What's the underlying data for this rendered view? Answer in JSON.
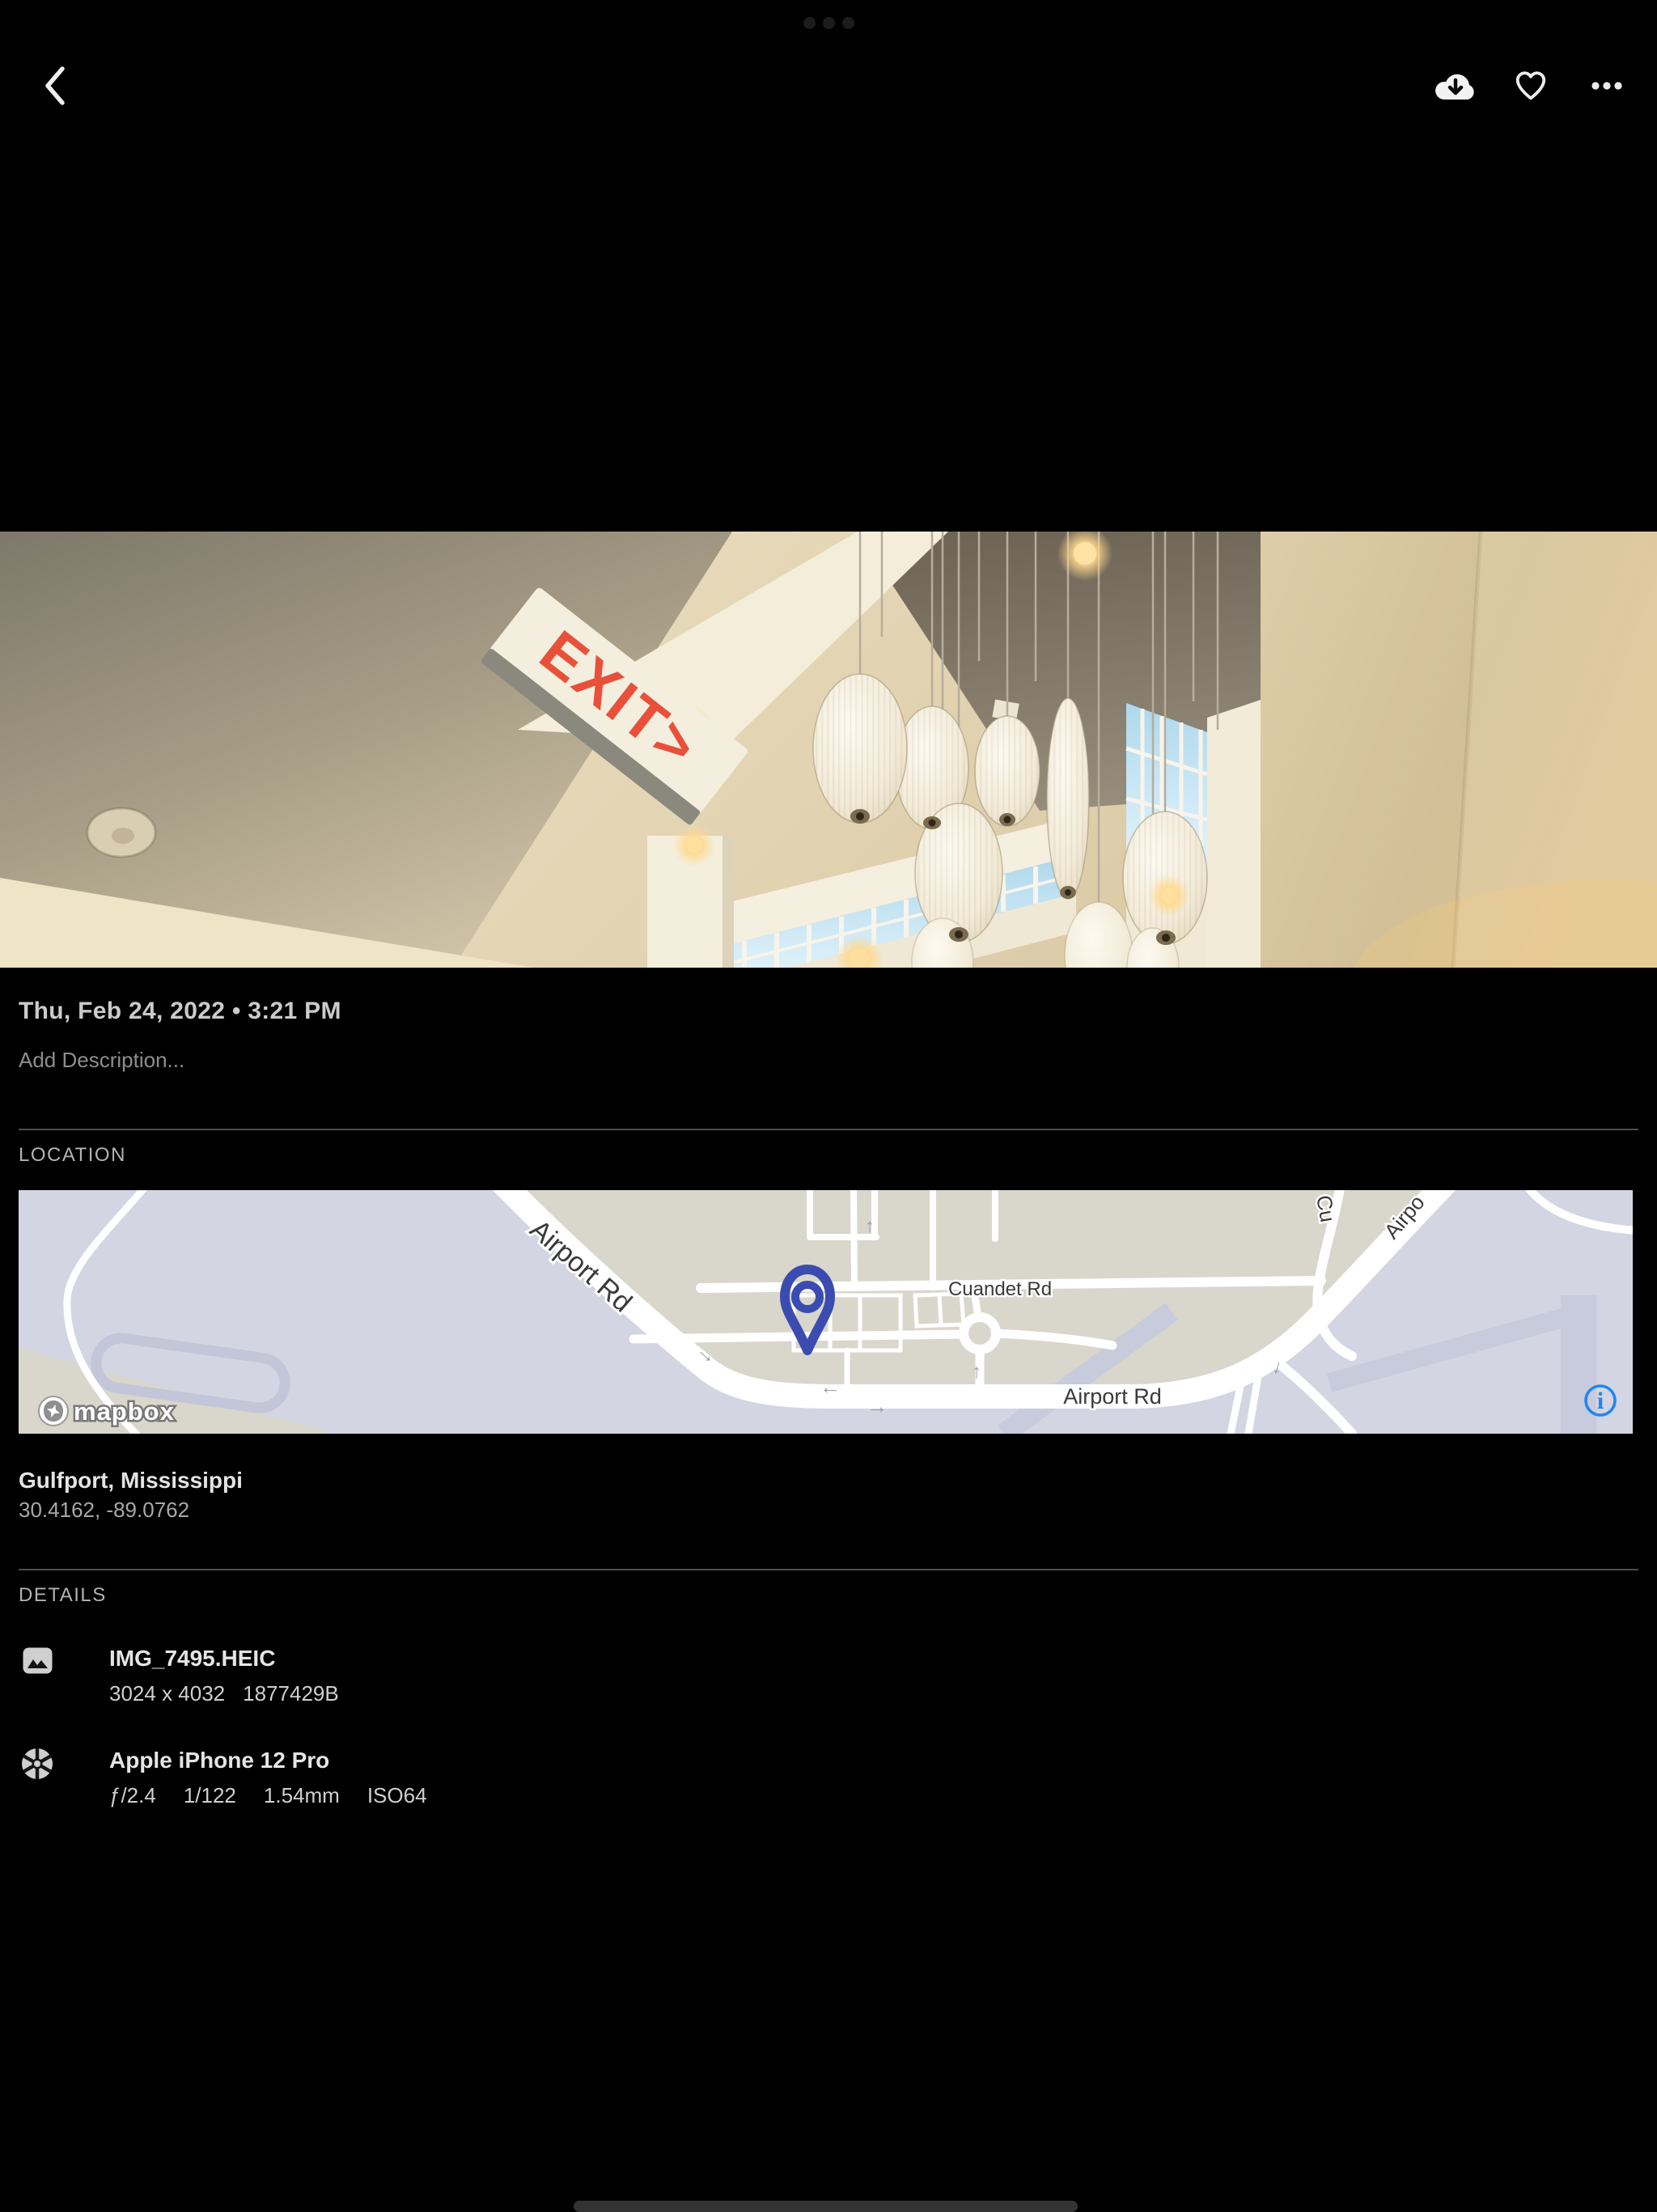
{
  "icons": {
    "back": "chevron-left",
    "download": "cloud-download",
    "favorite": "heart-outline",
    "more": "ellipsis",
    "file": "image",
    "camera": "aperture",
    "map_pin": "location-pin",
    "map_info": "info-circle",
    "attribution_logo": "mapbox-logo"
  },
  "colors": {
    "background": "#000000",
    "map_pin": "#3b4cb0",
    "info_blue": "#1f87f0",
    "map_land": "#d9d6cc",
    "map_field": "#d3d5e2"
  },
  "photo": {
    "exit_sign_text": "EXIT>"
  },
  "meta": {
    "date_time": "Thu, Feb 24, 2022 • 3:21 PM",
    "description_placeholder": "Add Description..."
  },
  "location": {
    "header": "LOCATION",
    "place": "Gulfport, Mississippi",
    "coordinates": "30.4162, -89.0762",
    "map": {
      "label_airport_main": "Airport Rd",
      "label_cuandet": "Cuandet Rd",
      "label_airport_lower": "Airport Rd",
      "label_clipped_cu": "Cu",
      "label_clipped_airpo": "Airpo",
      "attribution": "mapbox",
      "info_glyph": "i"
    }
  },
  "details": {
    "header": "DETAILS",
    "file": {
      "name": "IMG_7495.HEIC",
      "resolution": "3024 x 4032",
      "size_bytes": "1877429B"
    },
    "camera": {
      "model": "Apple iPhone 12 Pro",
      "aperture": "ƒ/2.4",
      "shutter_speed": "1/122",
      "focal_length": "1.54mm",
      "iso": "ISO64"
    }
  }
}
